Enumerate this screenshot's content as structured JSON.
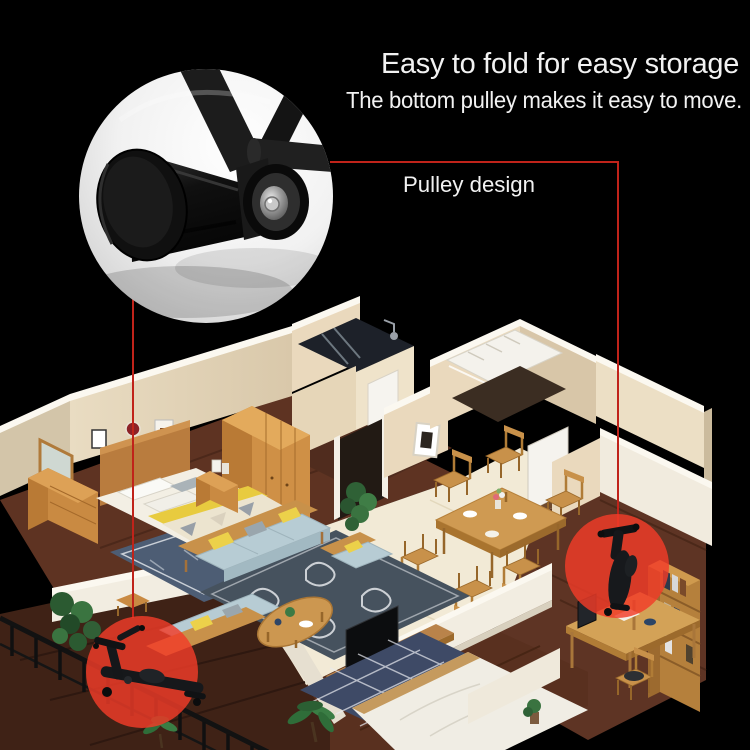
{
  "canvas": {
    "background": "#000000"
  },
  "header": {
    "title": "Easy to fold for easy storage",
    "subtitle": "The bottom pulley makes it easy to move."
  },
  "callout": {
    "label": "Pulley design",
    "leader_line_color": "#c0231a"
  },
  "highlight": {
    "circle_color": "#f23c28",
    "left_target": "unfolded-machine-on-balcony",
    "right_target": "folded-machine-in-study"
  },
  "text_color": "#f2f2f2"
}
